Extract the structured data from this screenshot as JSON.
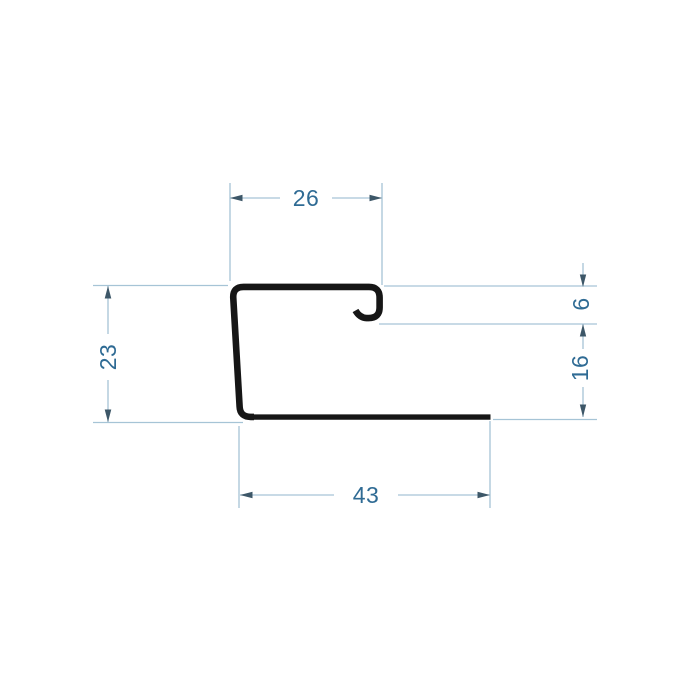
{
  "drawing": {
    "colors": {
      "profile": "#161616",
      "dim_line": "#a6c4d6",
      "dim_arrow": "#3d5768",
      "dim_text": "#2f6b94",
      "background": "#ffffff"
    },
    "dimensions": [
      {
        "id": "top-width",
        "label": "26",
        "orientation": "horizontal"
      },
      {
        "id": "left-height",
        "label": "23",
        "orientation": "vertical"
      },
      {
        "id": "hook-return-depth",
        "label": "6",
        "orientation": "vertical"
      },
      {
        "id": "right-flange-height",
        "label": "16",
        "orientation": "vertical"
      },
      {
        "id": "bottom-width",
        "label": "43",
        "orientation": "horizontal"
      }
    ]
  }
}
